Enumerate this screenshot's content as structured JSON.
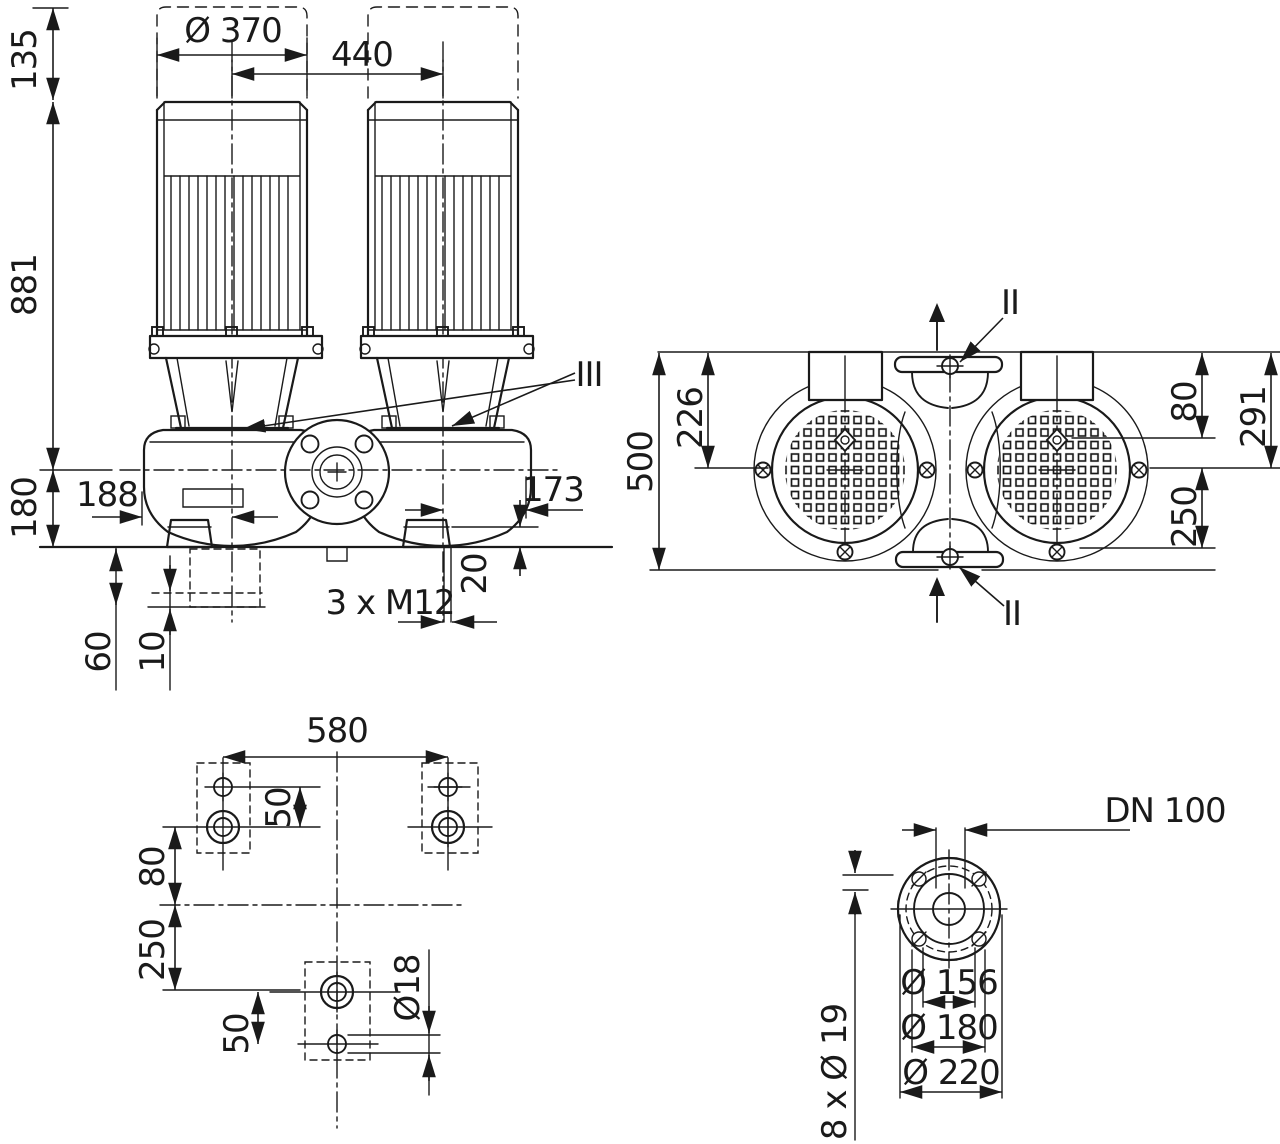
{
  "colors": {
    "line": "#1a1a1a",
    "background": "#ffffff"
  },
  "drawing": {
    "front_view": {
      "d135": "135",
      "d_motor_diameter": "Ø 370",
      "d_axis_spacing": "440",
      "d_total_height": "881",
      "d_base_height": "180",
      "d_suction_offset": "188",
      "d_discharge_offset": "173",
      "d_pad_height": "20",
      "d_anchor_depth": "60",
      "d_plate_thickness": "10",
      "anchor_bolt_label": "3 x M12",
      "seal_reference": "III"
    },
    "top_view": {
      "d_width": "500",
      "d_box_offset": "226",
      "d_port_offset": "80",
      "d_height": "291",
      "d_center_to_edge": "250",
      "vent_reference_top": "II",
      "vent_reference_bottom": "II"
    },
    "foundation_view": {
      "d_bolt_spacing": "580",
      "d_hole_pair_top": "50",
      "d_center_offset": "80",
      "d_lower_offset": "250",
      "d_hole_pair_bottom": "50",
      "d_hole_diameter": "Ø18"
    },
    "flange_view": {
      "nominal_label": "DN 100",
      "d_pilot": "Ø 156",
      "d_bolt_circle": "Ø 180",
      "d_outer": "Ø 220",
      "bolt_holes_label": "8 x Ø 19"
    }
  }
}
